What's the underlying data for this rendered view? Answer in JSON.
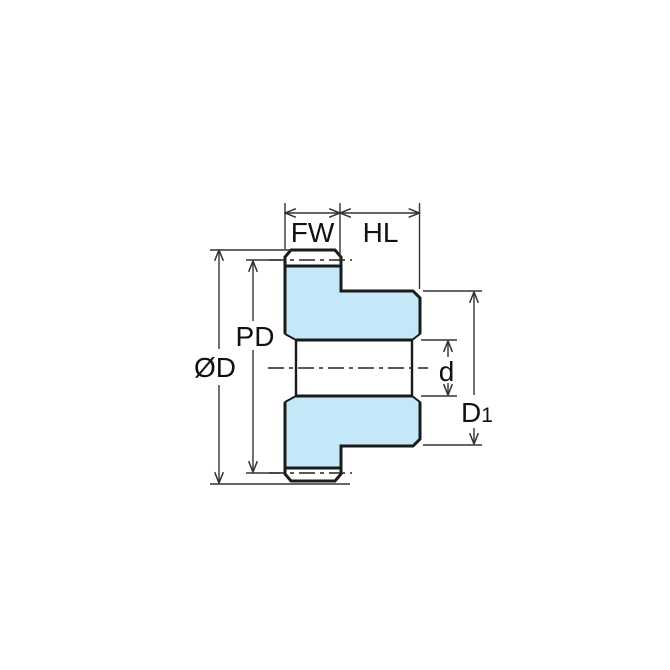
{
  "diagram": {
    "labels": {
      "face_width": "FW",
      "hub_length": "HL",
      "pitch_diameter": "PD",
      "outside_diameter": "ØD",
      "bore_diameter": "d",
      "hub_diameter_main": "D",
      "hub_diameter_sub": "1"
    },
    "colors": {
      "part_fill": "#c5e8f8",
      "outline": "#1a1a1a",
      "dimension_lines": "#333333"
    }
  }
}
